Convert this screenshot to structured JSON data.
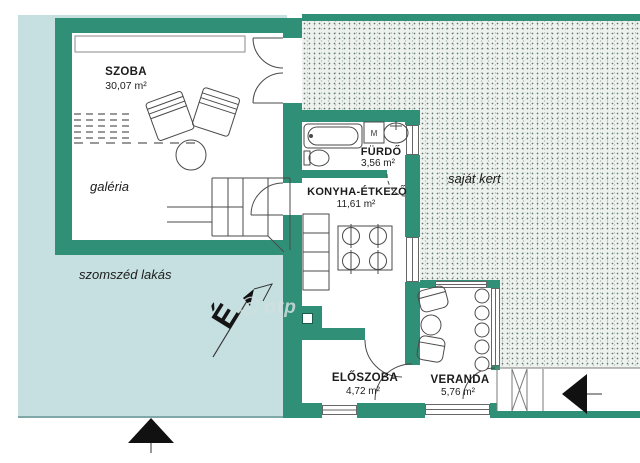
{
  "plan": {
    "rooms": [
      {
        "name": "SZOBA",
        "area": "30,07 m²"
      },
      {
        "name": "galéria",
        "area": ""
      },
      {
        "name": "FÜRDŐ",
        "area": "3,56 m²"
      },
      {
        "name": "KONYHA-ÉTKEZŐ",
        "area": "11,61 m²"
      },
      {
        "name": "ELŐSZOBA",
        "area": "4,72 m²"
      },
      {
        "name": "VERANDA",
        "area": "5,76 m²"
      }
    ],
    "outdoor": {
      "garden": "saját kert",
      "neighbor": "szomszéd lakás"
    },
    "compass": {
      "north": "É"
    },
    "appliances": {
      "washer": "M"
    },
    "watermark": "ⓒ otp",
    "colors": {
      "wall": "#2f9077",
      "neighbor_fill": "#c6e0e1",
      "garden_fill": "#eef2ef",
      "marker": "#111111"
    }
  }
}
